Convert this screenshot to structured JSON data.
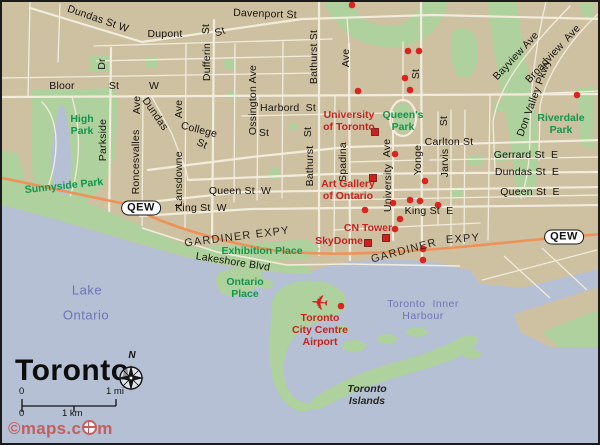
{
  "map": {
    "title": "Toronto",
    "compass": "N",
    "scale": {
      "mi_start": "0",
      "mi_end": "1 mi",
      "km_start": "0",
      "km_end": "1 km"
    },
    "credit": {
      "full": "©maps.com",
      "before_globe": "©maps.c",
      "after_globe": "m"
    },
    "colors": {
      "land": "#cdc1a2",
      "water": "#b5c0d4",
      "park": "#aed19d",
      "road": "#f2ecdc",
      "highway_orange": "#ee9258",
      "poi_red": "#c42320",
      "marker_red": "#da2420",
      "park_text": "#13954e",
      "water_text": "#6d74b6",
      "street_text": "#17130e"
    },
    "qew_badges": [
      {
        "label": "QEW",
        "x": 139,
        "y": 206
      },
      {
        "label": "QEW",
        "x": 562,
        "y": 235
      }
    ],
    "labels": {
      "street": [
        {
          "t": "Dundas St W",
          "x": 96,
          "y": 17,
          "r": 19
        },
        {
          "t": "Davenport St",
          "x": 263,
          "y": 12,
          "r": 2
        },
        {
          "t": "Dupont",
          "x": 163,
          "y": 32,
          "r": 0
        },
        {
          "t": "St",
          "x": 218,
          "y": 30,
          "r": -20
        },
        {
          "t": "Dufferin",
          "x": 205,
          "y": 60,
          "r": -90
        },
        {
          "t": "St",
          "x": 204,
          "y": 27,
          "r": -90
        },
        {
          "t": "Dr",
          "x": 100,
          "y": 62,
          "r": -90
        },
        {
          "t": "Parkside",
          "x": 101,
          "y": 138,
          "r": -90
        },
        {
          "t": "Bloor",
          "x": 60,
          "y": 84,
          "r": 0
        },
        {
          "t": "St",
          "x": 112,
          "y": 84,
          "r": 0
        },
        {
          "t": "W",
          "x": 152,
          "y": 84,
          "r": 0
        },
        {
          "t": "Ave",
          "x": 135,
          "y": 103,
          "r": -90
        },
        {
          "t": "Roncesvalles",
          "x": 134,
          "y": 160,
          "r": -90
        },
        {
          "t": "Ave",
          "x": 177,
          "y": 107,
          "r": -90
        },
        {
          "t": "Lansdowne",
          "x": 177,
          "y": 177,
          "r": -90
        },
        {
          "t": "Dundas",
          "x": 153,
          "y": 112,
          "r": 55
        },
        {
          "t": "Ossington Ave",
          "x": 251,
          "y": 98,
          "r": -90
        },
        {
          "t": "College",
          "x": 197,
          "y": 128,
          "r": 14
        },
        {
          "t": "St",
          "x": 200,
          "y": 142,
          "r": 25
        },
        {
          "t": "St",
          "x": 262,
          "y": 131,
          "r": 0
        },
        {
          "t": "Harbord  St",
          "x": 286,
          "y": 106,
          "r": 0
        },
        {
          "t": "Bathurst St",
          "x": 312,
          "y": 55,
          "r": -90
        },
        {
          "t": "Bathurst",
          "x": 308,
          "y": 164,
          "r": -90
        },
        {
          "t": "St",
          "x": 306,
          "y": 130,
          "r": -90
        },
        {
          "t": "Ave",
          "x": 344,
          "y": 56,
          "r": -90
        },
        {
          "t": "Spadina",
          "x": 341,
          "y": 160,
          "r": -90
        },
        {
          "t": "St",
          "x": 414,
          "y": 72,
          "r": -90
        },
        {
          "t": "Yonge",
          "x": 416,
          "y": 158,
          "r": -90
        },
        {
          "t": "Ave",
          "x": 385,
          "y": 146,
          "r": -90
        },
        {
          "t": "University",
          "x": 386,
          "y": 186,
          "r": -90
        },
        {
          "t": "St",
          "x": 442,
          "y": 119,
          "r": -90
        },
        {
          "t": "Jarvis",
          "x": 443,
          "y": 161,
          "r": -90
        },
        {
          "t": "Carlton St",
          "x": 447,
          "y": 140,
          "r": 0
        },
        {
          "t": "Gerrard St  E",
          "x": 524,
          "y": 153,
          "r": 0
        },
        {
          "t": "Dundas St  E",
          "x": 525,
          "y": 170,
          "r": 0
        },
        {
          "t": "Queen St  E",
          "x": 528,
          "y": 190,
          "r": 0
        },
        {
          "t": "Queen St  W",
          "x": 238,
          "y": 189,
          "r": 0
        },
        {
          "t": "King St  W",
          "x": 199,
          "y": 206,
          "r": 0
        },
        {
          "t": "King St  E",
          "x": 427,
          "y": 209,
          "r": 0
        },
        {
          "t": "Lakeshore Blvd",
          "x": 231,
          "y": 260,
          "r": 9
        },
        {
          "t": "Bayview Ave",
          "x": 514,
          "y": 54,
          "r": -47
        },
        {
          "t": "Don Valley Pkwy",
          "x": 532,
          "y": 96,
          "r": -70
        },
        {
          "t": "Broadview  Ave",
          "x": 551,
          "y": 52,
          "r": -47
        }
      ],
      "highway": [
        {
          "t": "GARDINER EXPY",
          "x": 235,
          "y": 235,
          "r": -7
        },
        {
          "t": "GARDINER",
          "x": 402,
          "y": 249,
          "r": -15
        },
        {
          "t": "EXPY",
          "x": 461,
          "y": 237,
          "r": -4
        }
      ],
      "park": [
        {
          "t": "High\nPark",
          "x": 80,
          "y": 123,
          "r": 0
        },
        {
          "t": "Sunnyside Park",
          "x": 62,
          "y": 184,
          "r": -6
        },
        {
          "t": "Exhibition Place",
          "x": 260,
          "y": 249,
          "r": 0
        },
        {
          "t": "Ontario\nPlace",
          "x": 243,
          "y": 286,
          "r": 0
        },
        {
          "t": "Queen's\nPark",
          "x": 401,
          "y": 119,
          "r": 0
        },
        {
          "t": "Riverdale\nPark",
          "x": 559,
          "y": 122,
          "r": 0
        }
      ],
      "water": [
        {
          "t": "Lake",
          "x": 85,
          "y": 288,
          "r": 0
        },
        {
          "t": "Ontario",
          "x": 84,
          "y": 313,
          "r": 0
        },
        {
          "t": "Toronto  Inner\nHarbour",
          "x": 421,
          "y": 308,
          "r": 0,
          "sm": true
        }
      ],
      "poi": [
        {
          "t": "University\nof Toronto",
          "x": 347,
          "y": 119,
          "r": 0
        },
        {
          "t": "Art Gallery\nof Ontario",
          "x": 346,
          "y": 188,
          "r": 0
        },
        {
          "t": "CN Tower",
          "x": 366,
          "y": 226,
          "r": 0
        },
        {
          "t": "SkyDome",
          "x": 337,
          "y": 239,
          "r": 0
        },
        {
          "t": "Toronto\nCity Centre\nAirport",
          "x": 318,
          "y": 328,
          "r": 0
        }
      ],
      "islands": [
        {
          "t": "Toronto\nIslands",
          "x": 365,
          "y": 393,
          "r": 0
        }
      ]
    },
    "markers": {
      "dots": [
        [
          350,
          3
        ],
        [
          406,
          49
        ],
        [
          417,
          49
        ],
        [
          403,
          76
        ],
        [
          356,
          89
        ],
        [
          408,
          88
        ],
        [
          575,
          93
        ],
        [
          393,
          152
        ],
        [
          423,
          179
        ],
        [
          391,
          201
        ],
        [
          408,
          198
        ],
        [
          418,
          199
        ],
        [
          436,
          203
        ],
        [
          363,
          208
        ],
        [
          398,
          217
        ],
        [
          393,
          227
        ],
        [
          421,
          247
        ],
        [
          421,
          258
        ],
        [
          339,
          304
        ]
      ],
      "squares": [
        [
          373,
          130
        ],
        [
          371,
          176
        ],
        [
          384,
          236
        ],
        [
          366,
          241
        ]
      ],
      "airplane": {
        "x": 317,
        "y": 308
      }
    }
  }
}
